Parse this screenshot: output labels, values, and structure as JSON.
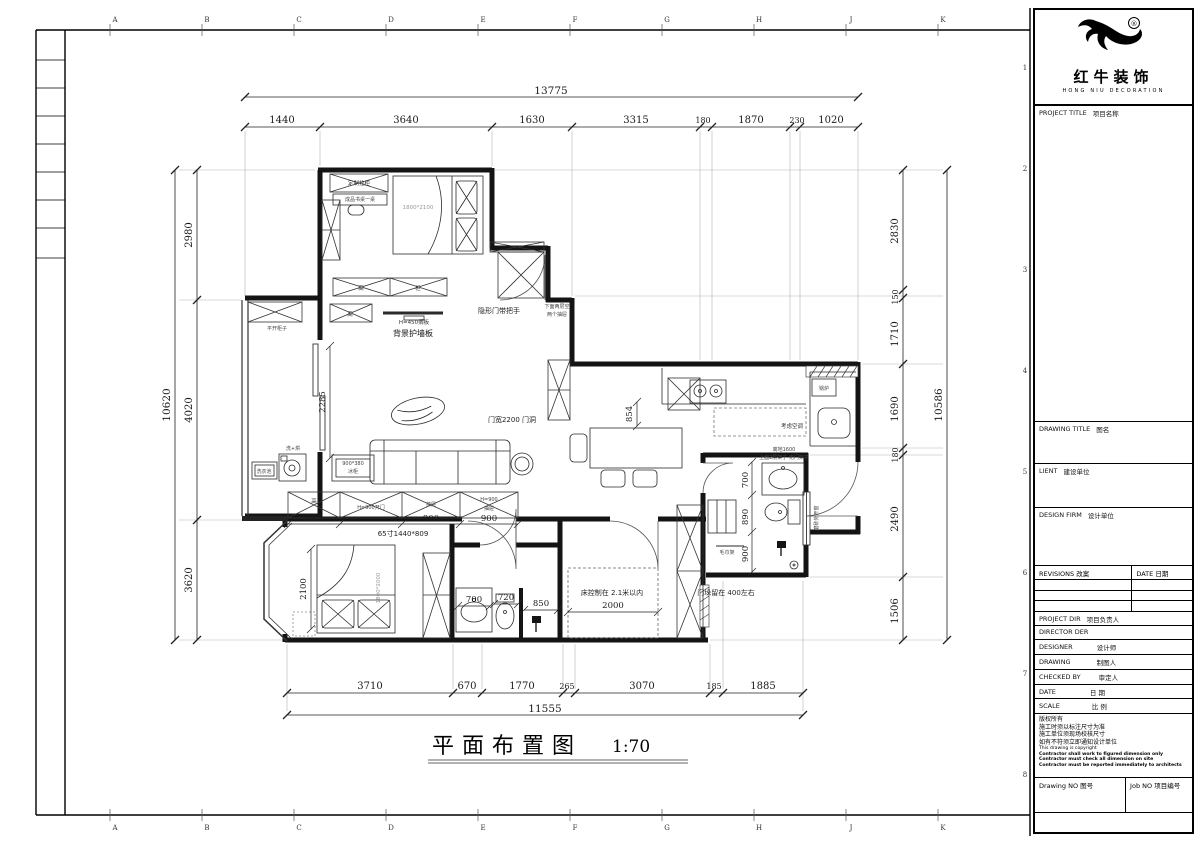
{
  "sheet": {
    "grid_letters": [
      "A",
      "B",
      "C",
      "D",
      "E",
      "F",
      "G",
      "H",
      "J",
      "K"
    ],
    "grid_numbers": [
      "1",
      "2",
      "3",
      "4",
      "5",
      "6",
      "7",
      "8"
    ]
  },
  "title_block": {
    "reg_mark": "®",
    "brand_name": "红牛装饰",
    "brand_sub": "HONG NIU DECORATION",
    "project_title_en": "PROJECT TITLE",
    "project_title_cn": "项目名称",
    "drawing_title_en": "DRAWING TITLE",
    "drawing_title_cn": "图名",
    "client_en": "LIENT",
    "client_cn": "建设单位",
    "design_firm_en": "DESIGN FIRM",
    "design_firm_cn": "设计单位",
    "revisions_en": "REVISIONS",
    "revisions_cn": "改案",
    "rev_date_en": "DATE",
    "rev_date_cn": "日期",
    "project_dir_en": "PROJECT DIR",
    "project_dir_cn": "项目负责人",
    "director_en": "DIRECTOR DER",
    "designer_en": "DESIGNER",
    "designer_cn": "设计师",
    "drawing_by_en": "DRAWING",
    "drawing_by_cn": "制图人",
    "checked_by_en": "CHECKED BY",
    "checked_by_cn": "审定人",
    "date_en": "DATE",
    "date_cn": "日  期",
    "scale_en": "SCALE",
    "scale_cn": "比  例",
    "copy_1": "版权所有",
    "copy_2": "施工时须以标注尺寸为准",
    "copy_3": "施工单位须现场校核尺寸",
    "copy_4": "如有不符须立即通知设计单位",
    "copy_5": "This drawing is copyright",
    "copy_b1": "Contractor shall work to figured dimension only",
    "copy_b2": "Contractor must check all dimension on site",
    "copy_b3": "Contractor must be reported immediately to architects",
    "drawing_no_en": "Drawing NO",
    "drawing_no_cn": "图号",
    "job_no_en": "Job NO",
    "job_no_cn": "项目编号"
  },
  "plan": {
    "title": "平面布置图",
    "scale": "1:70",
    "dims": {
      "top_total": "13775",
      "top": [
        "1440",
        "3640",
        "1630",
        "3315",
        "180",
        "1870",
        "230",
        "1020"
      ],
      "left_total": "10620",
      "left": [
        "2980",
        "4020",
        "3620"
      ],
      "right_total": "10586",
      "right": [
        "2830",
        "150",
        "1710",
        "1690",
        "180",
        "2490",
        "1506"
      ],
      "bottom_total": "11555",
      "bottom": [
        "3710",
        "670",
        "1770",
        "265",
        "3070",
        "185",
        "1885"
      ],
      "living_wall": "2285",
      "dining_gap": "854",
      "tv_row": [
        "880",
        "900",
        "900"
      ],
      "tv_note": "65寸1440*809",
      "bed2_width": "2100",
      "bath1": [
        "700",
        "720",
        "850"
      ],
      "bed3_width": "2000",
      "bath2": [
        "700",
        "890",
        "900"
      ]
    },
    "labels": {
      "custom_cabinet": "定制挂柜",
      "desk": "成品书桌一桌",
      "bed1_size": "1800*2100",
      "cab_tall": "高",
      "cab_gui": "柜",
      "hidden_door": "隐形门带把手",
      "drawers_note_1": "下面两层空",
      "drawers_note_2": "两个抽屉",
      "shelf": "H=450搁板",
      "wall_panel": "背景护墙板",
      "cab_tall2": "高",
      "balcony_cabinet": "平开柜子",
      "laundry_sink": "洗衣池",
      "washer": "洗+烘",
      "freezer_size": "900*380",
      "freezer": "冰柜",
      "door_opening": "门宽2200 门洞",
      "tv_cab_1": "高",
      "tv_cab_2": "H=900开门",
      "tv_cab_3": "抽屉",
      "tv_cab_4a": "H=900",
      "tv_cab_4b": "抽屉",
      "bed2_size": "1800*2000",
      "bed3_note": "床控制在 2.1米以内",
      "pier_note": "门垛留在 400左右",
      "towel_rack": "毛巾架",
      "window_note": "磨砂外开窗",
      "boiler": "锅炉",
      "ac_note": "考虑空调",
      "shelf_note_1": "离地1600",
      "shelf_note_2": "上面2层架子 无门架子"
    }
  }
}
